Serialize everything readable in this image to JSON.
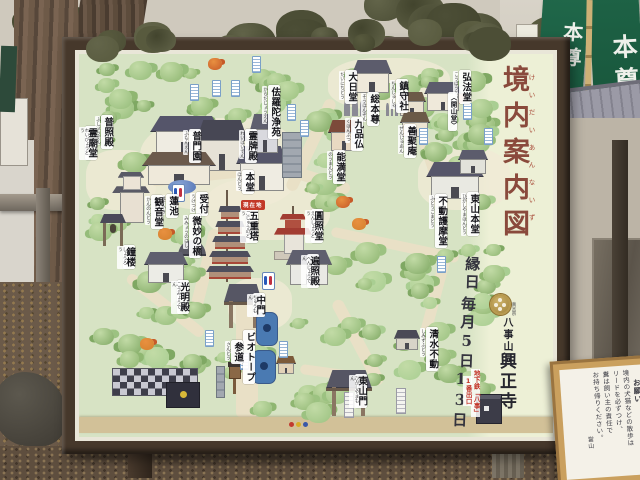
{
  "sign": {
    "title": "境内案内図",
    "title_furigana": "けいだいあんないず",
    "festival": [
      "縁日",
      "毎月5日",
      "13日"
    ],
    "sect": "真言宗",
    "mountain": "八事山",
    "temple": "興正寺",
    "subway_note": [
      "地下鉄「八事」",
      "1番出口"
    ],
    "you_are_here": "現在地",
    "title_color": "#8a4a3c",
    "accent_red": "#c23428",
    "crest_gold": "#b89a50"
  },
  "map": {
    "locations": [
      {
        "label": "普照殿",
        "furigana": "ふしょうでん",
        "x": 101,
        "y": 115
      },
      {
        "label": "霊廟堂",
        "furigana": "れいびょうどう",
        "x": 85,
        "y": 126
      },
      {
        "label": "普門園",
        "furigana": "ふもんえん",
        "x": 189,
        "y": 129
      },
      {
        "label": "佉羅陀浄苑",
        "furigana": "からだじょうえん",
        "x": 268,
        "y": 85
      },
      {
        "label": "大日堂",
        "furigana": "だいにちどう",
        "x": 345,
        "y": 70
      },
      {
        "label": "鎮守社",
        "furigana": "ちんじゅしゃ",
        "x": 396,
        "y": 79
      },
      {
        "label": "弘法堂",
        "furigana": "こうぼうどう",
        "x": 459,
        "y": 70
      },
      {
        "label": "〈開山堂〉",
        "furigana": "",
        "x": 448,
        "y": 92,
        "small": true
      },
      {
        "label": "総本尊",
        "furigana": "そうほんぞん",
        "x": 367,
        "y": 92
      },
      {
        "label": "九品仏",
        "furigana": "くほんぶつ",
        "x": 351,
        "y": 117
      },
      {
        "label": "善聚庵",
        "furigana": "ぜんじゅあん",
        "x": 404,
        "y": 124
      },
      {
        "label": "能満堂",
        "furigana": "のうまんどう",
        "x": 333,
        "y": 150
      },
      {
        "label": "霊牌殿",
        "furigana": "れいはいでん",
        "x": 245,
        "y": 129
      },
      {
        "label": "本堂",
        "furigana": "ほんどう",
        "x": 242,
        "y": 170
      },
      {
        "label": "東山本堂",
        "furigana": "ひがしやまほんどう",
        "x": 467,
        "y": 192
      },
      {
        "label": "不動護摩堂",
        "furigana": "ふどうごまどう",
        "x": 435,
        "y": 194
      },
      {
        "label": "受付",
        "furigana": "うけつけ",
        "x": 196,
        "y": 192
      },
      {
        "label": "蓮池",
        "furigana": "はすいけ",
        "x": 166,
        "y": 194
      },
      {
        "label": "観音堂",
        "furigana": "かんのんどう",
        "x": 151,
        "y": 195
      },
      {
        "label": "微妙の橋",
        "furigana": "みみょうのはし",
        "x": 189,
        "y": 214
      },
      {
        "label": "五重塔",
        "furigana": "ごじゅうのとう",
        "x": 246,
        "y": 209
      },
      {
        "label": "圓照堂",
        "furigana": "えんしょうどう",
        "x": 311,
        "y": 209
      },
      {
        "label": "遍照殿",
        "furigana": "へんじょうでん",
        "x": 307,
        "y": 254
      },
      {
        "label": "鐘楼",
        "furigana": "しょうろう",
        "x": 123,
        "y": 245
      },
      {
        "label": "光明殿",
        "furigana": "こうみょうでん",
        "x": 177,
        "y": 280
      },
      {
        "label": "中門",
        "furigana": "ちゅうもん",
        "x": 253,
        "y": 293
      },
      {
        "label": "ビオトープ",
        "furigana": "",
        "x": 243,
        "y": 330
      },
      {
        "label": "参道",
        "furigana": "さんどう",
        "x": 231,
        "y": 340
      },
      {
        "label": "清水不動",
        "furigana": "しみずふどう",
        "x": 426,
        "y": 327
      },
      {
        "label": "東山門",
        "furigana": "ひがしやまもん",
        "x": 355,
        "y": 374
      }
    ],
    "features": [
      {
        "name": "fumonen-complex-roof",
        "type": "hall",
        "x": 150,
        "y": 116,
        "w": 72,
        "h": 40,
        "roof": "#55556a",
        "body": "#efece2"
      },
      {
        "name": "fumonen-dark-hall",
        "type": "hall",
        "x": 196,
        "y": 120,
        "w": 52,
        "h": 52,
        "roof": "#474754",
        "body": "#e6e2d6"
      },
      {
        "name": "west-wing-hall",
        "type": "hall",
        "x": 142,
        "y": 152,
        "w": 74,
        "h": 34,
        "roof": "#6b5a4c",
        "body": "#efe9da"
      },
      {
        "name": "hondo-hall",
        "type": "hall",
        "x": 236,
        "y": 146,
        "w": 52,
        "h": 46,
        "roof": "#56566a",
        "body": "#efece2"
      },
      {
        "name": "reihaiden-building",
        "type": "hall",
        "x": 250,
        "y": 114,
        "w": 30,
        "h": 40,
        "roof": "#5f5f6e",
        "body": "#d9d9de"
      },
      {
        "name": "karada-joen-monument",
        "type": "slab",
        "x": 282,
        "y": 132,
        "w": 18,
        "h": 44
      },
      {
        "name": "dainichido-hall",
        "type": "hall",
        "x": 352,
        "y": 60,
        "w": 40,
        "h": 34,
        "roof": "#5c5c6c",
        "body": "#efe9da"
      },
      {
        "name": "chinjusha-shrine",
        "type": "hall",
        "x": 398,
        "y": 92,
        "w": 28,
        "h": 24,
        "roof": "#6b5a48",
        "body": "#e9e1d0"
      },
      {
        "name": "kobodo-hall",
        "type": "hall",
        "x": 424,
        "y": 82,
        "w": 38,
        "h": 30,
        "roof": "#5c5c6c",
        "body": "#efe9da"
      },
      {
        "name": "zenjuan-hall",
        "type": "hall",
        "x": 400,
        "y": 112,
        "w": 30,
        "h": 26,
        "roof": "#6b5a48",
        "body": "#ece4d2"
      },
      {
        "name": "nomando-hall",
        "type": "hall",
        "x": 328,
        "y": 120,
        "w": 32,
        "h": 32,
        "roof": "#7c4a3a",
        "body": "#e9d9c2"
      },
      {
        "name": "kubonbutsu-statues",
        "type": "statues",
        "x": 344,
        "y": 96,
        "w": 24,
        "h": 20
      },
      {
        "name": "sohonzon-statue",
        "type": "statues",
        "x": 386,
        "y": 100,
        "w": 14,
        "h": 16
      },
      {
        "name": "higashiyama-hondo-hall",
        "type": "hall",
        "x": 426,
        "y": 162,
        "w": 58,
        "h": 38,
        "roof": "#56566a",
        "body": "#e9e9e2"
      },
      {
        "name": "fudo-gomado-hall",
        "type": "hall",
        "x": 458,
        "y": 150,
        "w": 30,
        "h": 24,
        "roof": "#5c5c6c",
        "body": "#e2e2da"
      },
      {
        "name": "kannondo-hall",
        "type": "pagoda2",
        "x": 112,
        "y": 166,
        "w": 38,
        "h": 58
      },
      {
        "name": "shoro-bell-tower",
        "type": "bell",
        "x": 100,
        "y": 214,
        "w": 26,
        "h": 32
      },
      {
        "name": "lotus-pond",
        "type": "pond",
        "x": 168,
        "y": 180,
        "w": 28,
        "h": 14
      },
      {
        "name": "mimyo-bridge",
        "type": "bridge",
        "x": 178,
        "y": 240,
        "w": 28,
        "h": 14
      },
      {
        "name": "five-story-pagoda",
        "type": "pagoda5",
        "x": 206,
        "y": 190,
        "w": 48,
        "h": 92
      },
      {
        "name": "ensho-do-red-pagoda",
        "type": "redpagoda",
        "x": 274,
        "y": 206,
        "w": 38,
        "h": 54
      },
      {
        "name": "henjoden-hall",
        "type": "hall",
        "x": 286,
        "y": 250,
        "w": 46,
        "h": 36,
        "roof": "#5f5f6e",
        "body": "#e9e9e4"
      },
      {
        "name": "komyoden-hall",
        "type": "hall",
        "x": 144,
        "y": 252,
        "w": 44,
        "h": 32,
        "roof": "#5f5f6e",
        "body": "#ecece6"
      },
      {
        "name": "chumon-gate",
        "type": "gate",
        "x": 224,
        "y": 284,
        "w": 38,
        "h": 44
      },
      {
        "name": "higashiyama-gate",
        "type": "gate",
        "x": 326,
        "y": 370,
        "w": 46,
        "h": 46
      },
      {
        "name": "shimizu-fudo-shrine",
        "type": "hall",
        "x": 394,
        "y": 330,
        "w": 26,
        "h": 20,
        "roof": "#4a4a56",
        "body": "#d8d4c8"
      },
      {
        "name": "biotope-pond-upper",
        "type": "bluepond",
        "x": 256,
        "y": 312,
        "w": 20,
        "h": 32
      },
      {
        "name": "biotope-pond-lower",
        "type": "bluepond",
        "x": 252,
        "y": 350,
        "w": 22,
        "h": 32
      },
      {
        "name": "checkered-wall",
        "type": "checker",
        "x": 112,
        "y": 368,
        "w": 84,
        "h": 26
      },
      {
        "name": "checkered-wall-dark",
        "type": "checkerdark",
        "x": 166,
        "y": 382,
        "w": 32,
        "h": 24
      },
      {
        "name": "stone-pillar",
        "type": "slab",
        "x": 216,
        "y": 366,
        "w": 7,
        "h": 30
      },
      {
        "name": "wood-lantern",
        "type": "lantern",
        "x": 228,
        "y": 362,
        "w": 12,
        "h": 32
      },
      {
        "name": "small-shrine",
        "type": "hall",
        "x": 276,
        "y": 356,
        "w": 20,
        "h": 18,
        "roof": "#7c5a3a",
        "body": "#e2d2b8"
      },
      {
        "name": "subway-exit-structure",
        "type": "subway",
        "x": 476,
        "y": 394,
        "w": 24,
        "h": 28
      }
    ],
    "legend_dots": [
      "#c23a30",
      "#d8ae28",
      "#3a58a8"
    ]
  },
  "photo": {
    "banner_left": "本尊",
    "banner_right": "本尊",
    "notice": {
      "heading": "お願い",
      "lines": [
        "境内の犬猫などの散歩は",
        "リードを必ずつけ、",
        "糞は飼い主の責任で",
        "お持ち帰りください。"
      ],
      "signature": "當山"
    }
  }
}
